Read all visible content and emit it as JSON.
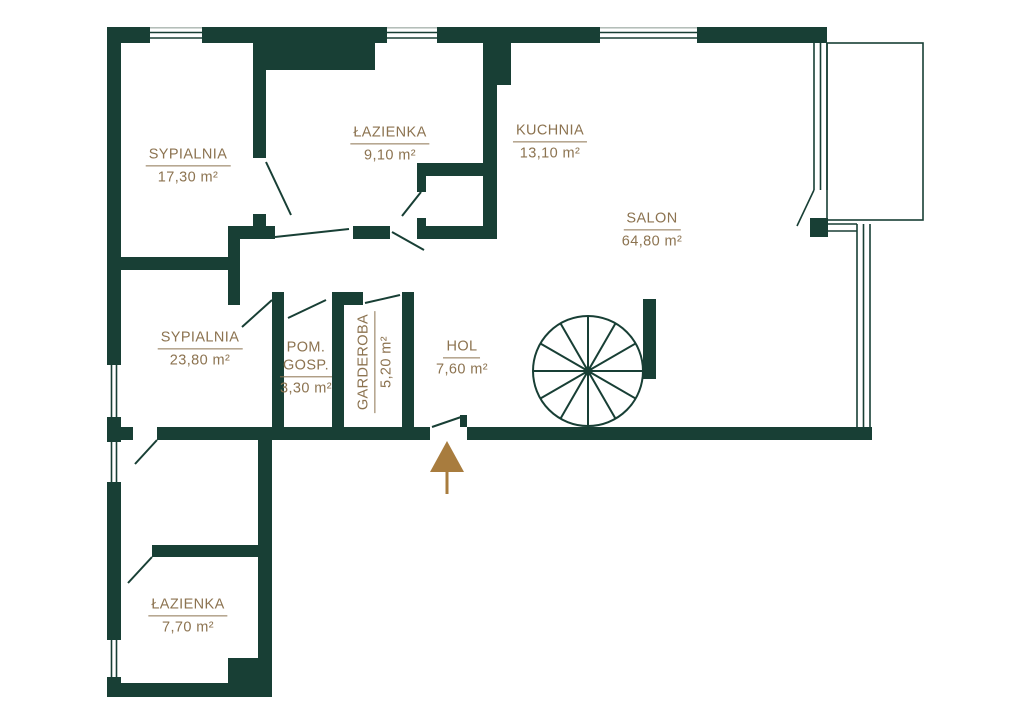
{
  "title": "apartment-floor-plan",
  "colors": {
    "wall": "#183f35",
    "label_text": "#8c7350",
    "entrance_arrow": "#a87c3e",
    "background": "#ffffff"
  },
  "rooms": [
    {
      "id": "sypialnia-1",
      "name": "SYPIALNIA",
      "area": "17,30 m²"
    },
    {
      "id": "lazienka-1",
      "name": "ŁAZIENKA",
      "area": "9,10 m²"
    },
    {
      "id": "kuchnia",
      "name": "KUCHNIA",
      "area": "13,10 m²"
    },
    {
      "id": "salon",
      "name": "SALON",
      "area": "64,80 m²"
    },
    {
      "id": "sypialnia-2",
      "name": "SYPIALNIA",
      "area": "23,80 m²"
    },
    {
      "id": "pom-gosp",
      "name_line1": "POM.",
      "name_line2": "GOSP.",
      "area": "3,30 m²"
    },
    {
      "id": "garderoba",
      "name": "GARDEROBA",
      "area": "5,20 m²"
    },
    {
      "id": "hol",
      "name": "HOL",
      "area": "7,60 m²"
    },
    {
      "id": "lazienka-2",
      "name": "ŁAZIENKA",
      "area": "7,70 m²"
    }
  ],
  "symbols": {
    "entrance_arrow": "entrance-direction-arrow",
    "spiral_staircase": "spiral-staircase",
    "balcony_outline": "balcony-terrace"
  }
}
